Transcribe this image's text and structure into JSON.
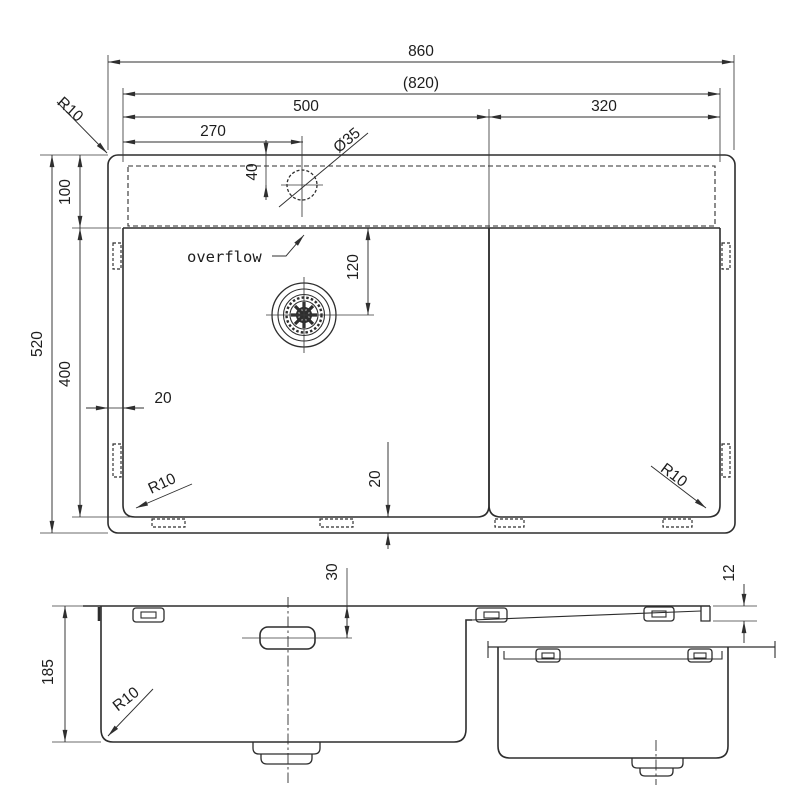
{
  "drawing": {
    "type": "technical dimension drawing",
    "subject": "kitchen sink with drainboard",
    "units": "mm",
    "line_color": "#2d2d2d",
    "background_color": "#ffffff"
  },
  "plan": {
    "overall_width": "860",
    "cutout_width": "(820)",
    "main_bowl_width": "500",
    "right_section_width": "320",
    "faucet_offset": "270",
    "faucet_diameter": "Ø35",
    "faucet_setback": "40",
    "rim_depth": "100",
    "overall_depth": "520",
    "bowl_length": "400",
    "drain_offset": "120",
    "side_gap": "20",
    "bottom_gap": "20",
    "corner_radius_top_left": "R10",
    "corner_radius_bottom_left": "R10",
    "corner_radius_bottom_right": "R10",
    "overflow_label": "overflow"
  },
  "front": {
    "bowl_depth": "185",
    "overflow_offset": "30",
    "rim_height": "12",
    "corner_radius": "R10"
  }
}
